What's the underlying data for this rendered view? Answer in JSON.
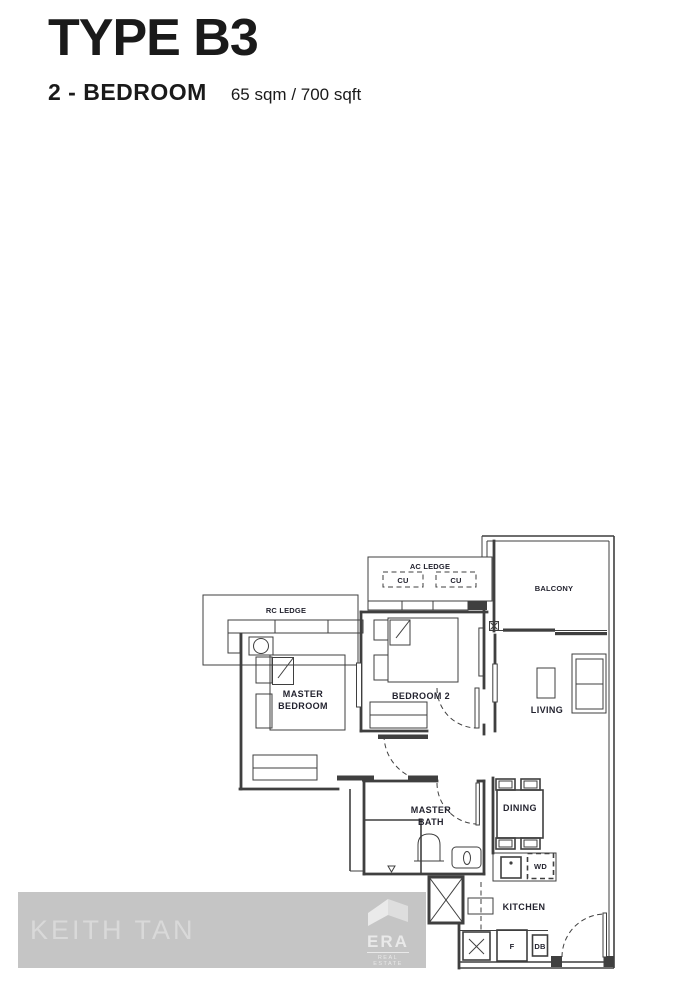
{
  "header": {
    "title": "TYPE B3",
    "subtitle": "2 - BEDROOM",
    "area": "65 sqm / 700 sqft"
  },
  "plan": {
    "labels": {
      "ac_ledge": "AC LEDGE",
      "cu_left": "CU",
      "cu_right": "CU",
      "balcony": "BALCONY",
      "rc_ledge": "RC LEDGE",
      "master_bedroom_l1": "MASTER",
      "master_bedroom_l2": "BEDROOM",
      "bedroom2": "BEDROOM 2",
      "living": "LIVING",
      "master_bath_l1": "MASTER",
      "master_bath_l2": "BATH",
      "dining": "DINING",
      "wd": "WD",
      "kitchen": "KITCHEN",
      "fridge": "F",
      "db": "DB"
    }
  },
  "watermark": {
    "agent": "KEITH TAN",
    "brand": "ERA",
    "brand_sub": "REAL ESTATE"
  },
  "colors": {
    "wall": "#3f3f3f",
    "label": "#23232f",
    "watermark_band": "#c5c5c5",
    "watermark_text": "#d9d9d9",
    "ink": "#1a1a1a"
  }
}
